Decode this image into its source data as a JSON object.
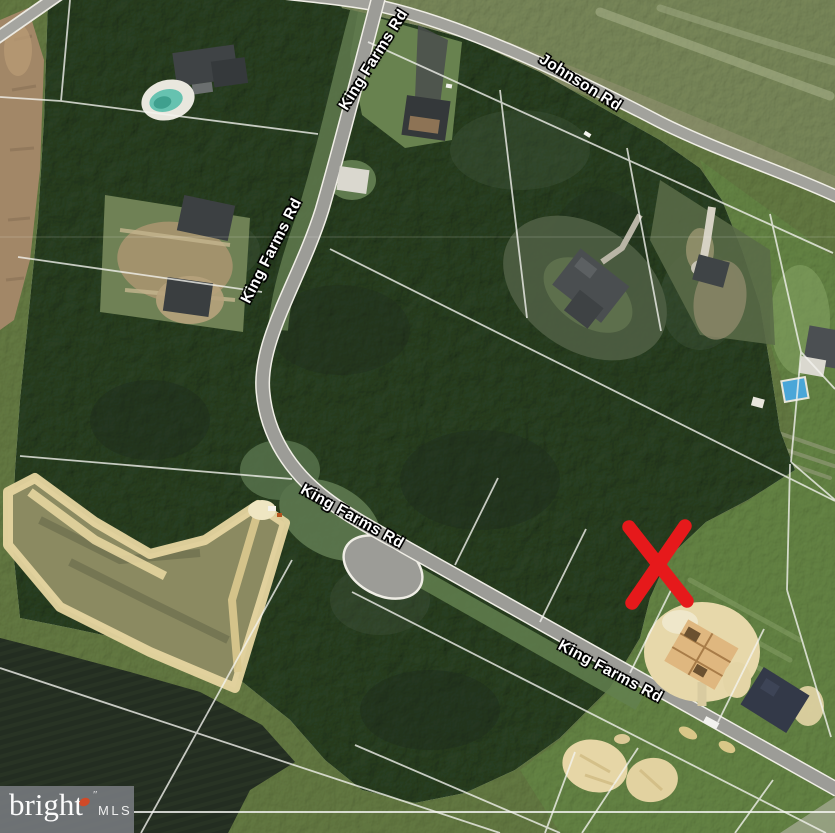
{
  "map": {
    "kind": "satellite-aerial-listing-photo",
    "road_labels": [
      {
        "name": "road-label-king-farms-rd-top",
        "text": "King Farms Rd",
        "x": 374,
        "y": 60,
        "rotation": -58
      },
      {
        "name": "road-label-king-farms-rd-upper",
        "text": "King Farms Rd",
        "x": 272,
        "y": 251,
        "rotation": -63
      },
      {
        "name": "road-label-king-farms-rd-middle",
        "text": "King Farms Rd",
        "x": 352,
        "y": 517,
        "rotation": 29
      },
      {
        "name": "road-label-king-farms-rd-lower",
        "text": "King Farms Rd",
        "x": 610,
        "y": 672,
        "rotation": 28
      },
      {
        "name": "road-label-johnson-rd",
        "text": "Johnson Rd",
        "x": 580,
        "y": 83,
        "rotation": 32
      }
    ],
    "marker": {
      "name": "red-x-marker",
      "color": "#e6191b",
      "x": 658,
      "y": 564
    }
  },
  "watermark": {
    "brand": "bright",
    "marks": "″",
    "suffix": "MLS",
    "accent_color": "#d04a28"
  }
}
